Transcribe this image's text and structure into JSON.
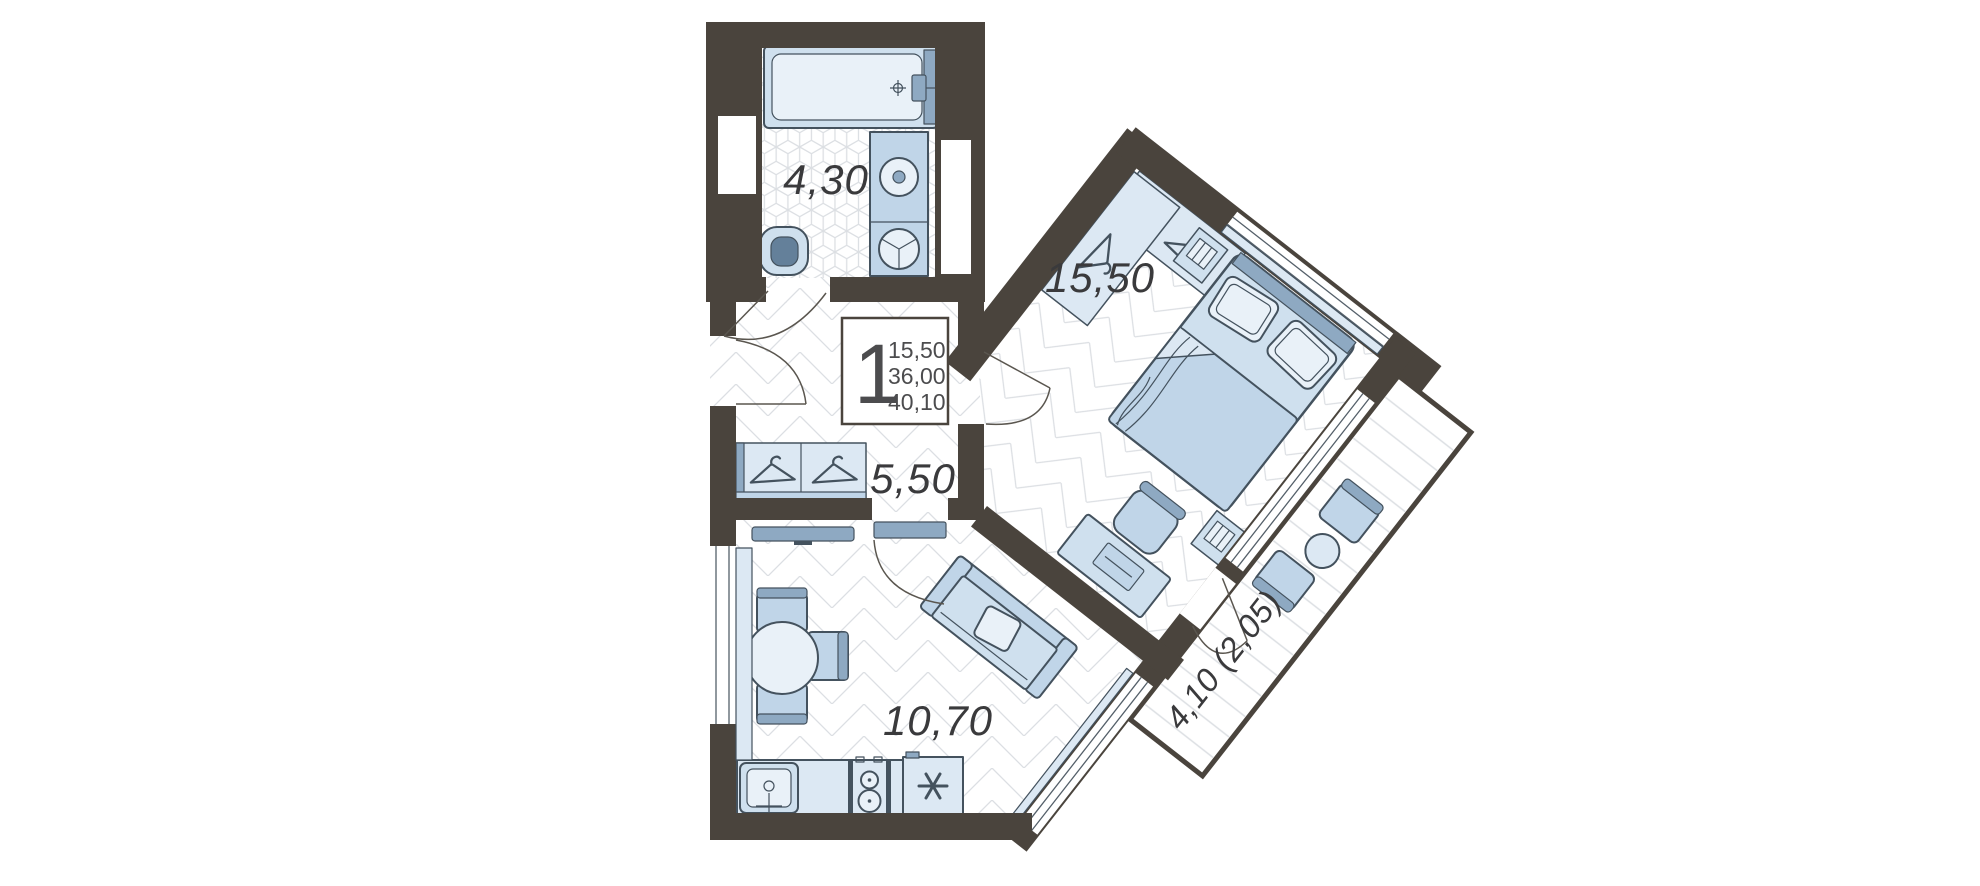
{
  "unit_info": {
    "rooms_count": "1",
    "living_area": "15,50",
    "apartment_area": "36,00",
    "total_area": "40,10"
  },
  "room_labels": {
    "bathroom": "4,30",
    "bedroom": "15,50",
    "hallway": "5,50",
    "kitchen_living": "10,70",
    "balcony": "4,10 (2,05)"
  },
  "colors": {
    "wall": "#4a443d",
    "outline": "#44525e",
    "floor_line": "#dcdfe3",
    "text": "#3a3a3c",
    "background": "#ffffff",
    "furniture_light": "#e9f1f8",
    "furniture_pale": "#dce8f3",
    "furniture_mid": "#cfe0ee",
    "furniture_med": "#c0d5e8",
    "furniture_dark": "#8ea9c2",
    "inner_dark": "#64809a"
  },
  "icons": {
    "bathtub": "bathtub-icon",
    "bath_faucet": "faucet-icon",
    "wash_basin": "round-basin-icon",
    "washing_machine": "washing-machine-drum-icon",
    "toilet": "toilet-icon",
    "vent": "vent-dashes-icon",
    "hanger": "clothes-hanger-icon",
    "tv": "flat-tv-icon",
    "dining_table": "round-dining-table-icon",
    "chair": "chair-icon",
    "sofa": "sofa-icon",
    "sofa_pillow": "pillow-icon",
    "desk": "desk-icon",
    "laptop": "laptop-icon",
    "desk_chair": "desk-chair-icon",
    "bed": "double-bed-icon",
    "bed_pillow": "pillow-icon",
    "blanket": "blanket-icon",
    "nightstand": "nightstand-icon",
    "wardrobe": "wardrobe-icon",
    "kitchen_sink": "kitchen-sink-icon",
    "stove": "two-burner-stove-icon",
    "fridge": "snowflake-asterisk-icon",
    "armchair": "armchair-icon",
    "balcony_table": "round-side-table-icon",
    "door": "door-swing-arc-icon",
    "window": "double-line-window-icon"
  }
}
